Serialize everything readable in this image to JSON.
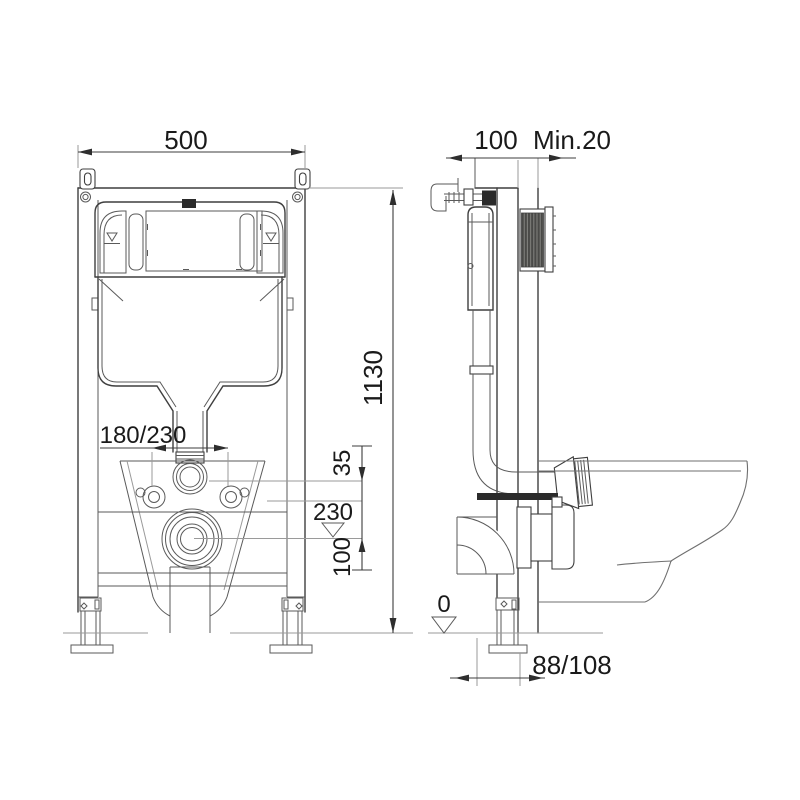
{
  "drawing_type": "installation-diagram-concealed-cistern-frame",
  "colors": {
    "background": "#ffffff",
    "object_line": "#3f3f3f",
    "thin_line": "#9a9a9a",
    "dimension_line": "#3c3c3c",
    "text": "#1a1a1a",
    "hatch_fill": "#4a4a48",
    "solid_fill": "#2b2b2b"
  },
  "labels": {
    "front": {
      "width": "500",
      "height": "1130",
      "bolt_spacing": "180/230",
      "flush_offset": "35",
      "invert_level": "230",
      "drop": "100"
    },
    "side": {
      "depth": "100",
      "wall_min": "Min.20",
      "floor": "0",
      "outlet_offset": "88/108"
    }
  }
}
